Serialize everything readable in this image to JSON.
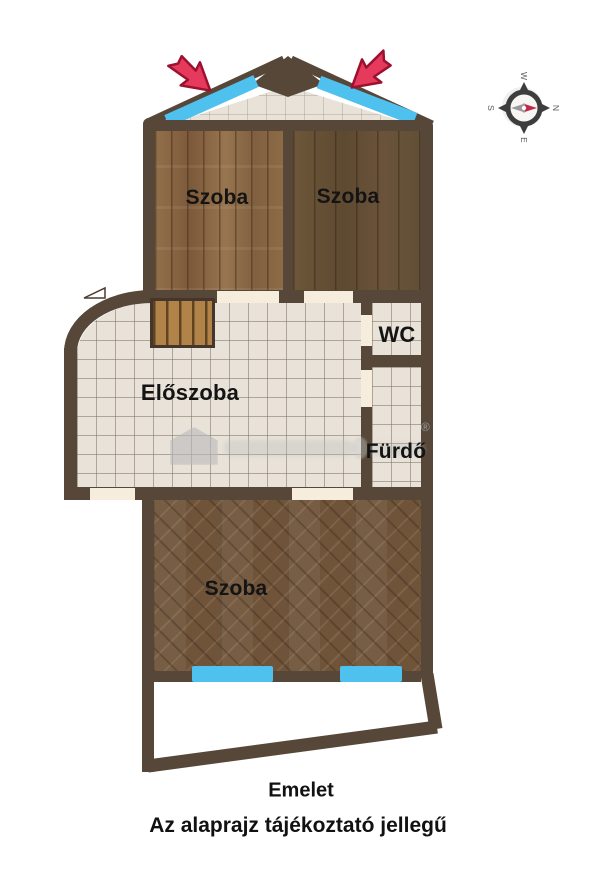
{
  "plan": {
    "rooms": {
      "szoba_top_left": "Szoba",
      "szoba_top_right": "Szoba",
      "wc": "WC",
      "eloszoba": "Előszoba",
      "furdo": "Fürdő",
      "szoba_bottom": "Szoba"
    },
    "captions": {
      "floor": "Emelet",
      "disclaimer": "Az alaprajz tájékoztató jellegű"
    },
    "compass": {
      "north": "N",
      "east": "E",
      "south": "S",
      "west": "W"
    },
    "watermark": {
      "registered_mark": "®"
    },
    "colors": {
      "wall": "#564738",
      "tile_floor": "#e8e2d9",
      "wood_light": "#876545",
      "wood_dark": "#645035",
      "parquet_herringbone": "#6f543a",
      "window_blue": "#4fc1ef",
      "arrow_red": "#e53a5c",
      "door_opening": "#f7eddc"
    }
  }
}
